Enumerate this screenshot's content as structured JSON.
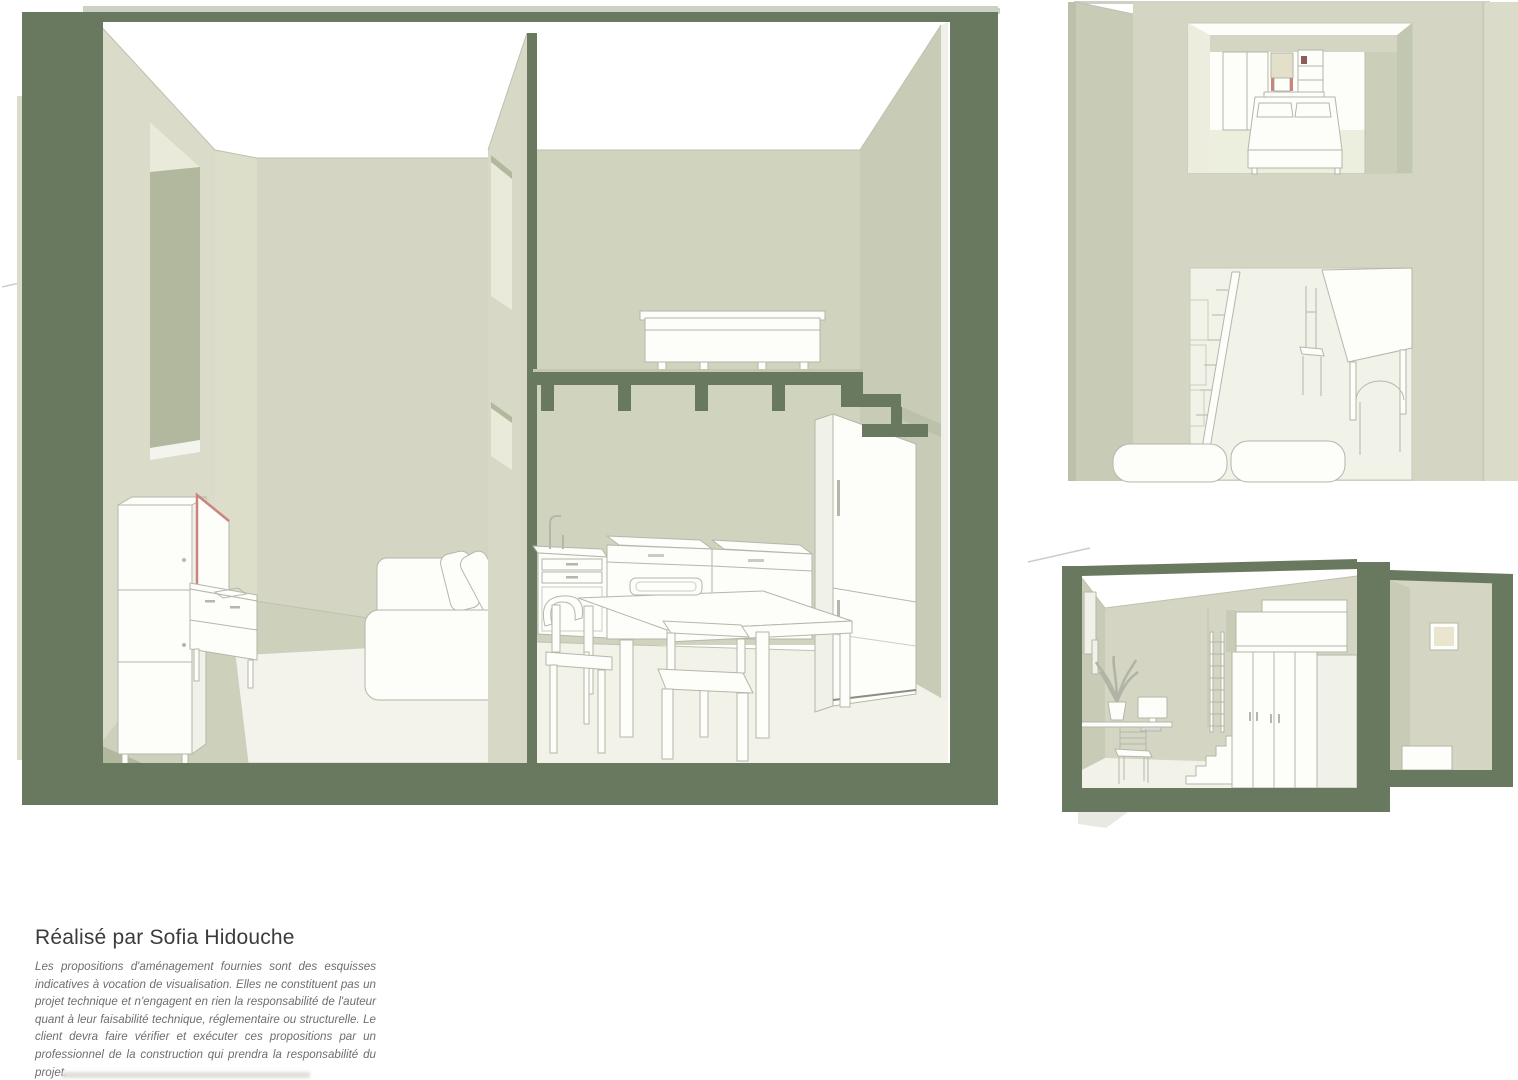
{
  "palette": {
    "cut_green": "#68795f",
    "cap_gray": "#cdd0c5",
    "wall_light": "#d4d6c3",
    "wall_lighter": "#dadcc9",
    "wall_mid": "#c8ccb6",
    "wall_dark": "#bcc2aa",
    "wall_deep": "#b2b89e",
    "wall_kitchen": "#d0d3be",
    "floor_sage": "#cdd1bc",
    "floor_cream": "#f2f2e9",
    "rug_cream": "#f3f3eb",
    "furn_white": "#fdfdfa",
    "furn_white2": "#f0f1e8",
    "outline_gray": "#b4b7aa",
    "outline_soft": "#cccec0",
    "edge_line": "#bdc1af",
    "opening_cream": "#e9ead9",
    "opening_white": "#f4f4ee",
    "accent_red": "#c9857d",
    "accent_dark": "#8d5e57",
    "text_dark": "#3b3b3b",
    "text_gray": "#6e6e6e",
    "shadow_gray": "#d8d8d3"
  },
  "credit": {
    "title": "Réalisé par Sofia Hidouche",
    "disclaimer": "Les propositions d'aménagement fournies sont des esquisses indicatives à vocation de visualisation. Elles ne constituent pas un projet technique et n'engagent en rien la responsabilité de l'auteur quant à leur faisabilité technique, réglementaire ou structurelle. Le client devra faire vérifier et exécuter ces propositions par un professionnel de la construction qui prendra la responsabilité du projet."
  }
}
